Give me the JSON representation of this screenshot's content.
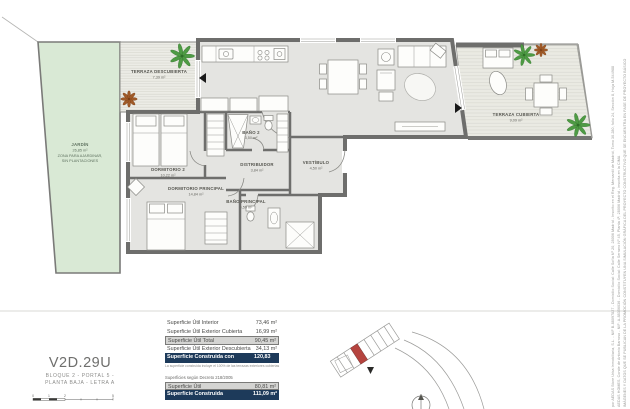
{
  "colors": {
    "wall": "#6e6e6c",
    "interior": "#e4e4e1",
    "garden": "#d9e9d5",
    "terrace": "#ecece6",
    "navy": "#1d3a5a",
    "rowgray": "#d4d4d2",
    "red": "#b5443f",
    "green": "#4e9b44",
    "brown": "#a05a28"
  },
  "plan": {
    "rooms": {
      "jardin": {
        "name": "JARDÍN",
        "area": "26,85 m²",
        "note1": "ZONA PARA AJARDINAR,",
        "note2": "SIN PLANTACIONES"
      },
      "terraza_descubierta": {
        "name": "TERRAZA DESCUBIERTA",
        "area": "7,39 m²"
      },
      "dormitorio2": {
        "name": "DORMITORIO 2",
        "area": "10,22 m²"
      },
      "bano2": {
        "name": "BAÑO 2",
        "area": "3,50 m²"
      },
      "distribuidor": {
        "name": "DISTRIBUIDOR",
        "area": "3,84 m²"
      },
      "vestibulo": {
        "name": "VESTÍBULO",
        "area": "4,50 m²"
      },
      "dormitorio_principal": {
        "name": "DORMITORIO PRINCIPAL",
        "area": "14,84 m²"
      },
      "bano_principal": {
        "name": "BAÑO PRINCIPAL",
        "area": "4,59 m²"
      },
      "terraza_cubierta": {
        "name": "TERRAZA CUBIERTA",
        "area": "9,09 m²"
      }
    }
  },
  "unit": {
    "code": "V2D.29U",
    "location_line1": "BLOQUE 2 - PORTAL 5 -",
    "location_line2": "PLANTA BAJA - LETRA A",
    "scale_labels": [
      "0",
      "1",
      "2",
      "5"
    ]
  },
  "surfaces": {
    "rows": [
      {
        "label": "Superficie Útil Interior",
        "value": "73,46 m²",
        "style": "plain"
      },
      {
        "label": "Superficie Útil Exterior Cubierta",
        "value": "16,99 m²",
        "style": "plain"
      },
      {
        "label": "Superficie Útil Total",
        "value": "90,45 m²",
        "style": "gray"
      },
      {
        "label": "Superficie Útil Exterior Descubierta",
        "value": "34,13 m²",
        "style": "plain"
      },
      {
        "label": "Superficie Construida con Comunes",
        "value": "120,83 m²",
        "style": "navy"
      }
    ],
    "note": "La superficie construida incluye el 100% de las terrazas exteriores cubiertas",
    "decree_heading": "Superficies según Decreto 218/2005",
    "decree_rows": [
      {
        "label": "Superficie Útil",
        "value": "80,81 m²",
        "style": "gray"
      },
      {
        "label": "Superficie Construida",
        "value": "111,09 m²",
        "style": "navy"
      }
    ]
  },
  "disclaimer": {
    "lines": [
      "IMÁGENES Y DATOS QUE SE PUBLICAN DE LA PROMOCIÓN CONSTITUYEN UNA SIMULACIÓN GRÁFICA DEL PROYECTO CONSTRUCTIVO QUE SE ENCUENTRA EN FASE DE PROYECTO BÁSICO",
      "AEDAS HOMES, Conde de Antonio Barroso - NIF: A-88356036 - Domicilio Social: Calle Serrano Nº 45, Planta 4ª, 28006 Madrid - inscrita en la CIMA",
      "por AEDAS Store Urba Inmobiliaria, S.L. - NIF B-88097827 - Domicilio Social: Calle Sofía Nº 20, 28006 Madrid - Inscrito en el Reg. Mercantil de Madrid, Tomo 30.280, folio 24, Sección 8, Hoja M-544988"
    ]
  }
}
